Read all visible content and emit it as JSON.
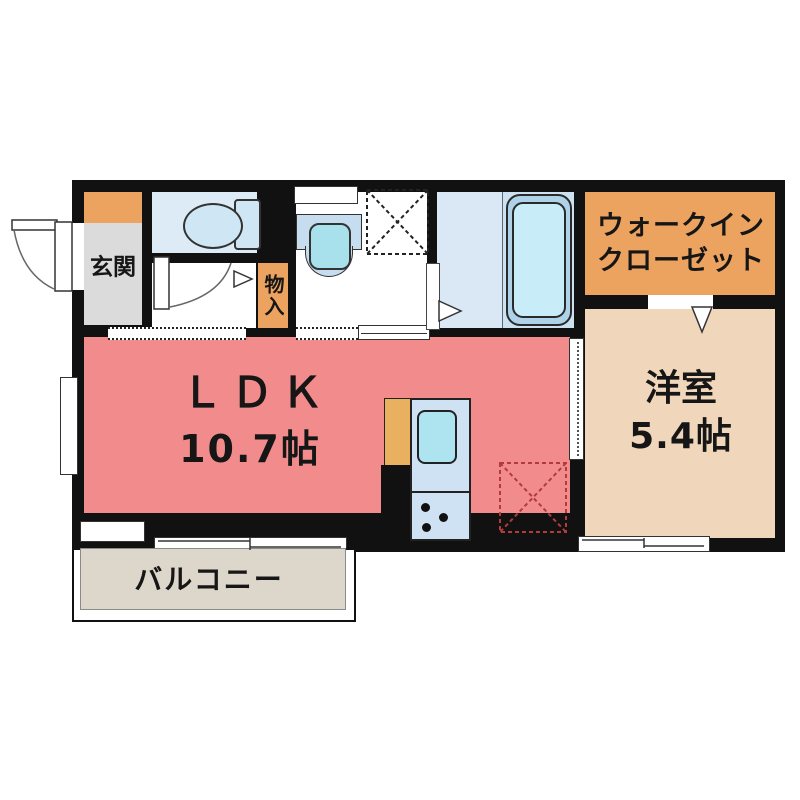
{
  "plan": {
    "type": "floor-plan",
    "rooms": {
      "genkan": {
        "label": "玄関"
      },
      "monoire": {
        "label": "物入"
      },
      "wic": {
        "label_line1": "ウォークイン",
        "label_line2": "クローゼット"
      },
      "ldk": {
        "label": "ＬＤＫ",
        "size": "10.7帖"
      },
      "youshitsu": {
        "label": "洋室",
        "size": "5.4帖"
      },
      "balcony": {
        "label": "バルコニー"
      }
    },
    "colors": {
      "wall": "#111111",
      "ldk_floor": "#f28c8c",
      "youshitsu_floor": "#f0d6bb",
      "closet_orange": "#eca35f",
      "genkan_gray": "#dbdbdb",
      "wet_area_blue": "#dcebf6",
      "fixture_blue": "#aee3f0",
      "balcony_gray": "#ddd6ca",
      "fridge_dash_red": "#b23b3b"
    },
    "fixtures": [
      "toilet",
      "wash-basin",
      "bathtub",
      "washing-machine-space",
      "kitchen-sink",
      "stove",
      "refrigerator-space"
    ]
  }
}
